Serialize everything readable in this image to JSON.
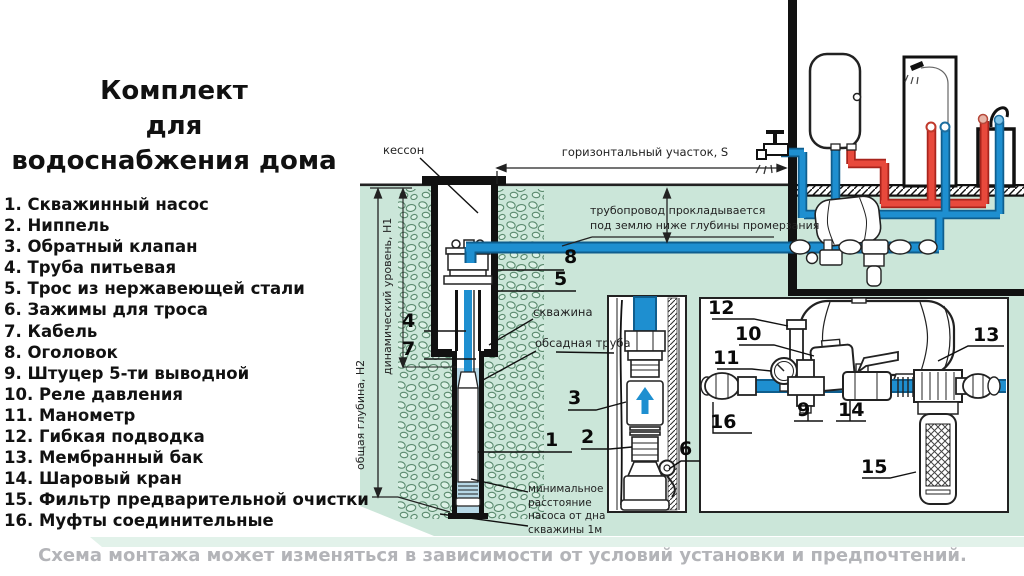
{
  "title": {
    "line1": "Комплект",
    "line2": "для",
    "line3": "водоснабжения дома"
  },
  "parts_list": {
    "items": [
      "1. Скважинный насос",
      "2. Ниппель",
      "3. Обратный клапан",
      "4. Труба питьевая",
      "5. Трос из нержавеющей стали",
      "6. Зажимы для троса",
      "7. Кабель",
      "8. Оголовок",
      "9. Штуцер 5-ти выводной",
      "10. Реле давления",
      "11. Манометр",
      "12. Гибкая подводка",
      "13. Мембранный бак",
      "14. Шаровый кран",
      "15. Фильтр предварительной очистки",
      "16. Муфты соединительные"
    ]
  },
  "diagram": {
    "labels": {
      "kesson": "кессон",
      "horizontal_section": "горизонтальный участок,  S",
      "frost_note_line1": "трубопровод прокладывается",
      "frost_note_line2": "под землю ниже глубины промерзания",
      "borehole": "скважина",
      "casing": "обсадная труба",
      "total_depth": "общая глубина, Н2",
      "dynamic_level": "динамический уровень, Н1",
      "min_distance": "минимальное расстояние насоса от дна скважины 1м"
    },
    "callouts": {
      "c1": "1",
      "c2": "2",
      "c3": "3",
      "c4": "4",
      "c5": "5",
      "c6": "6",
      "c7": "7",
      "c8": "8",
      "c9": "9",
      "c10": "10",
      "c11": "11",
      "c12": "12",
      "c13": "13",
      "c14": "14",
      "c15": "15",
      "c16": "16"
    }
  },
  "caption": "Схема монтажа может изменяться в зависимости от условий установки и предпочтений.",
  "colors": {
    "pipe_cold": "#1e8fd0",
    "pipe_hot": "#e8493c",
    "ground_green": "#cbe6d9",
    "water_blue": "#b7d8e6",
    "caption_gray": "#b3b4b8"
  }
}
